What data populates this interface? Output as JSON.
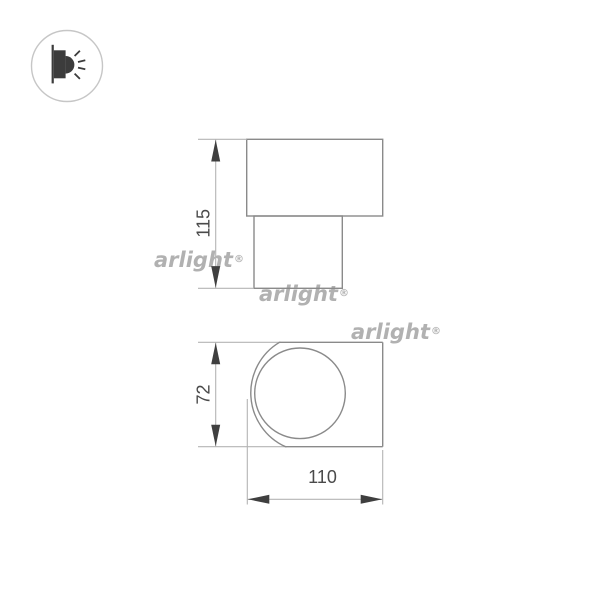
{
  "brand_watermark": {
    "text": "arlight",
    "registered_mark": "®"
  },
  "legend_icon": {
    "name": "wall-light-emission-icon"
  },
  "front_view": {
    "height_mm": "115"
  },
  "side_view": {
    "height_mm": "72",
    "width_mm": "110"
  },
  "colors": {
    "background": "#ffffff",
    "outline": "#8a8a8a",
    "dimension_line": "#b4b4b4",
    "arrow": "#3f3f3f",
    "label": "#4a4a4a",
    "watermark": "#b1b1b1",
    "icon": "#3c3c3c",
    "icon_circle": "#c6c6c6"
  }
}
